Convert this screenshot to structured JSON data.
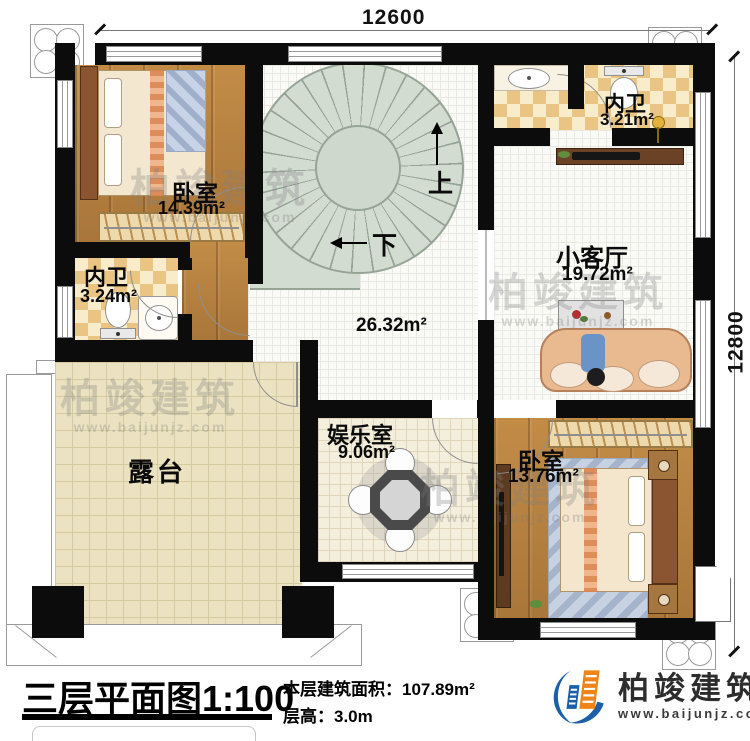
{
  "dimensions": {
    "top": "12600",
    "right": "12800"
  },
  "rooms": {
    "bedroom_top_left": {
      "name": "卧室",
      "area": "14.39m²"
    },
    "bathroom_top_right": {
      "name": "内卫",
      "area": "3.21m²"
    },
    "bathroom_left": {
      "name": "内卫",
      "area": "3.24m²"
    },
    "living_small": {
      "name": "小客厅",
      "area": "19.72m²"
    },
    "hall": {
      "area": "26.32m²"
    },
    "entertainment": {
      "name": "娱乐室",
      "area": "9.06m²"
    },
    "bedroom_bottom_right": {
      "name": "卧室",
      "area": "13.76m²"
    },
    "terrace": {
      "name": "露台"
    }
  },
  "stairs": {
    "up_label": "上",
    "down_label": "下"
  },
  "watermark": {
    "text": "柏竣建筑",
    "url": "www.baijunjz.com"
  },
  "footer": {
    "title": "三层平面图",
    "scale": "1:100",
    "area_label": "本层建筑面积：",
    "area_value": "107.89m²",
    "floor_height_label": "层高：",
    "floor_height_value": "3.0m"
  },
  "brand": {
    "name": "柏竣建筑",
    "url": "www.baijunjz.com"
  },
  "colors": {
    "brand_blue": "#1a5fa8",
    "brand_orange": "#ef8418",
    "wall": "#0c0c0c"
  }
}
